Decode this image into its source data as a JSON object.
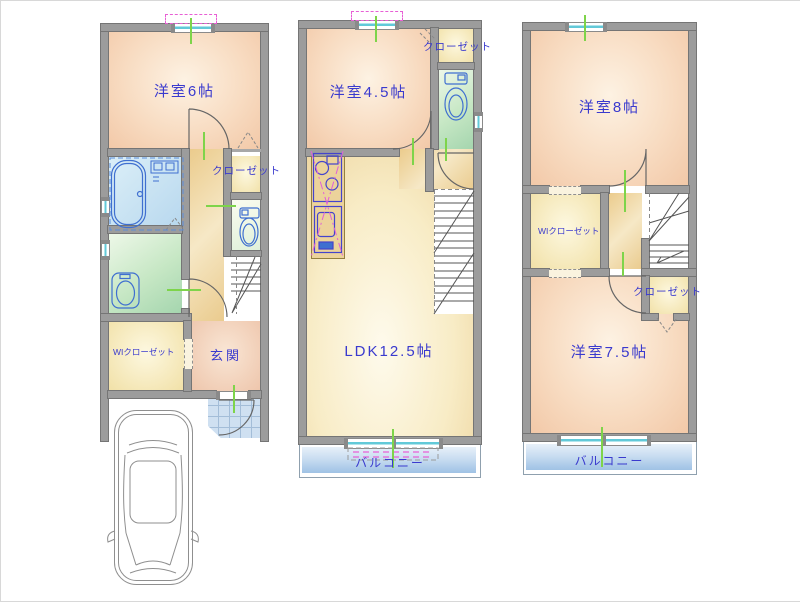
{
  "floor1": {
    "bedroom6": "洋室6帖",
    "closet": "クローゼット",
    "wic": "WIクローゼット",
    "entrance": "玄関"
  },
  "floor2": {
    "bedroom45": "洋室4.5帖",
    "closet": "クローゼット",
    "ldk": "LDK12.5帖",
    "balcony": "バルコニー"
  },
  "floor3": {
    "bedroom8": "洋室8帖",
    "wic": "WIクローゼット",
    "closet": "クローゼット",
    "bedroom75": "洋室7.5帖",
    "balcony": "バルコニー"
  },
  "colors": {
    "wall": "#9c9c9c",
    "wall_edge": "#757575",
    "label": "#3a3ace",
    "tick": "#7ed44a",
    "pink": "#e85fd5",
    "window_glass": "#62c9d8",
    "fixture": "#3f6fd0",
    "balcony": "#9fc2e5"
  }
}
